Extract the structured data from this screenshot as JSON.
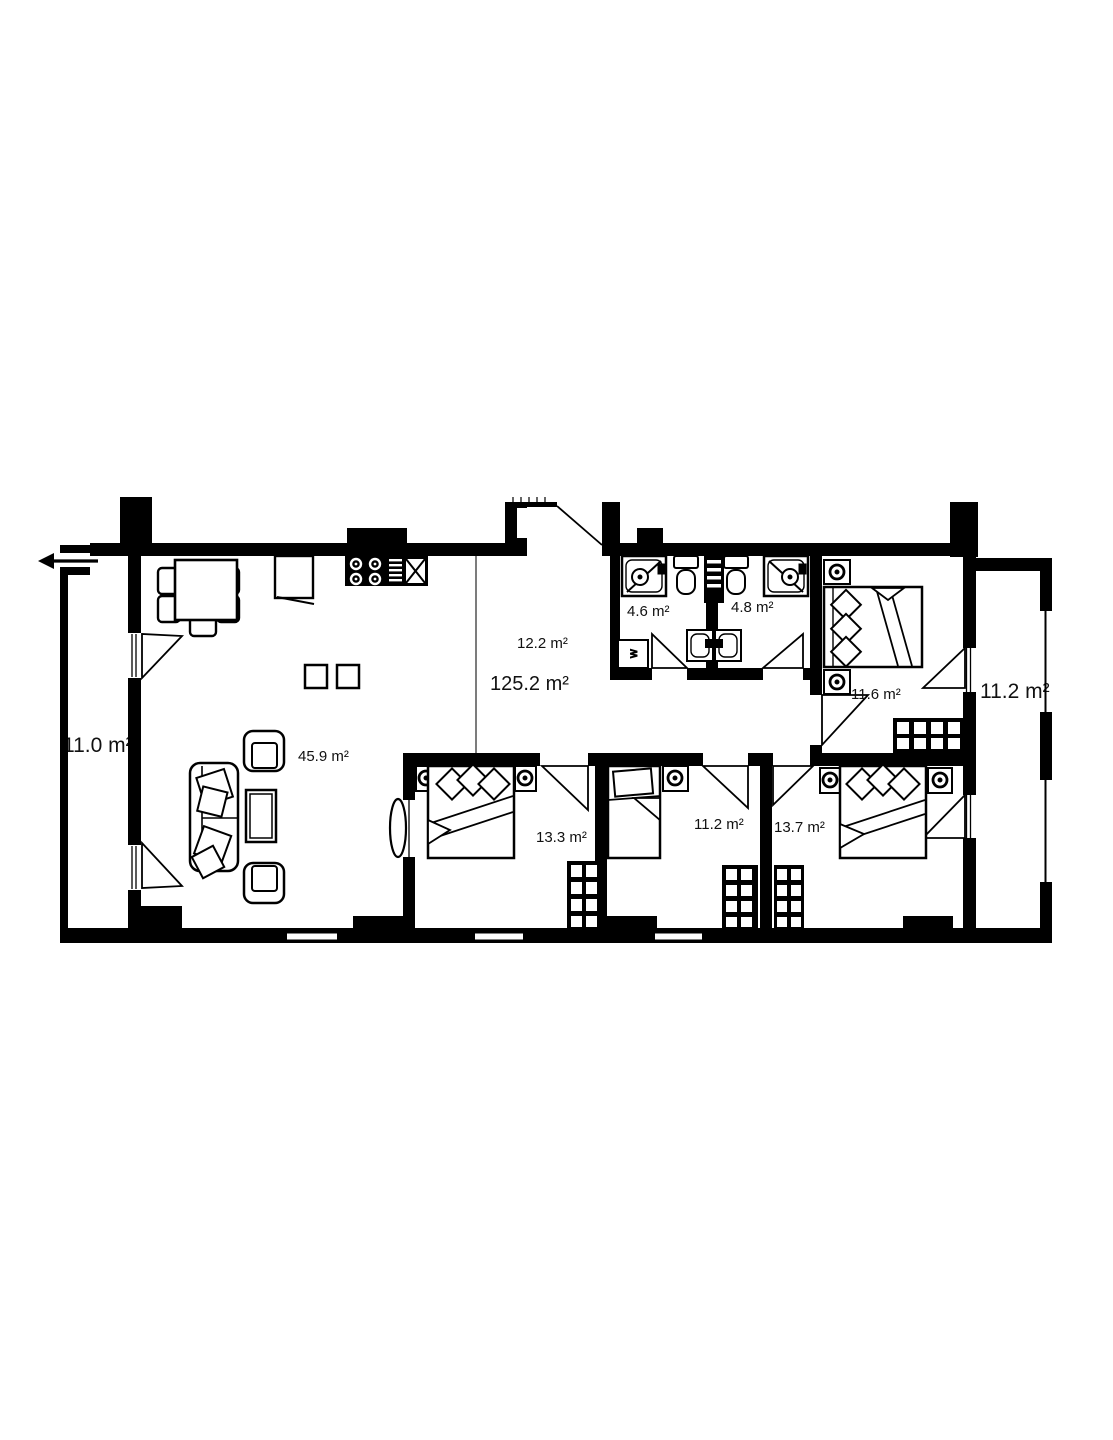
{
  "floor_plan": {
    "unit_total_area": "125.2 m²",
    "hall_area": "12.2 m²",
    "living_kitchen_area": "45.9 m²",
    "bathroom_small_area": "4.6 m²",
    "bathroom_large_area": "4.8 m²",
    "bedroom_top_right_area": "11.6 m²",
    "bedroom_bottom_left_area": "13.3 m²",
    "bedroom_bottom_middle_area": "11.2 m²",
    "bedroom_bottom_right_area": "13.7 m²",
    "balcony_left_area": "11.0 m²",
    "balcony_right_area": "11.2 m²",
    "washing_machine_label": "w",
    "colors": {
      "walls": "#000000",
      "background": "#ffffff"
    }
  }
}
